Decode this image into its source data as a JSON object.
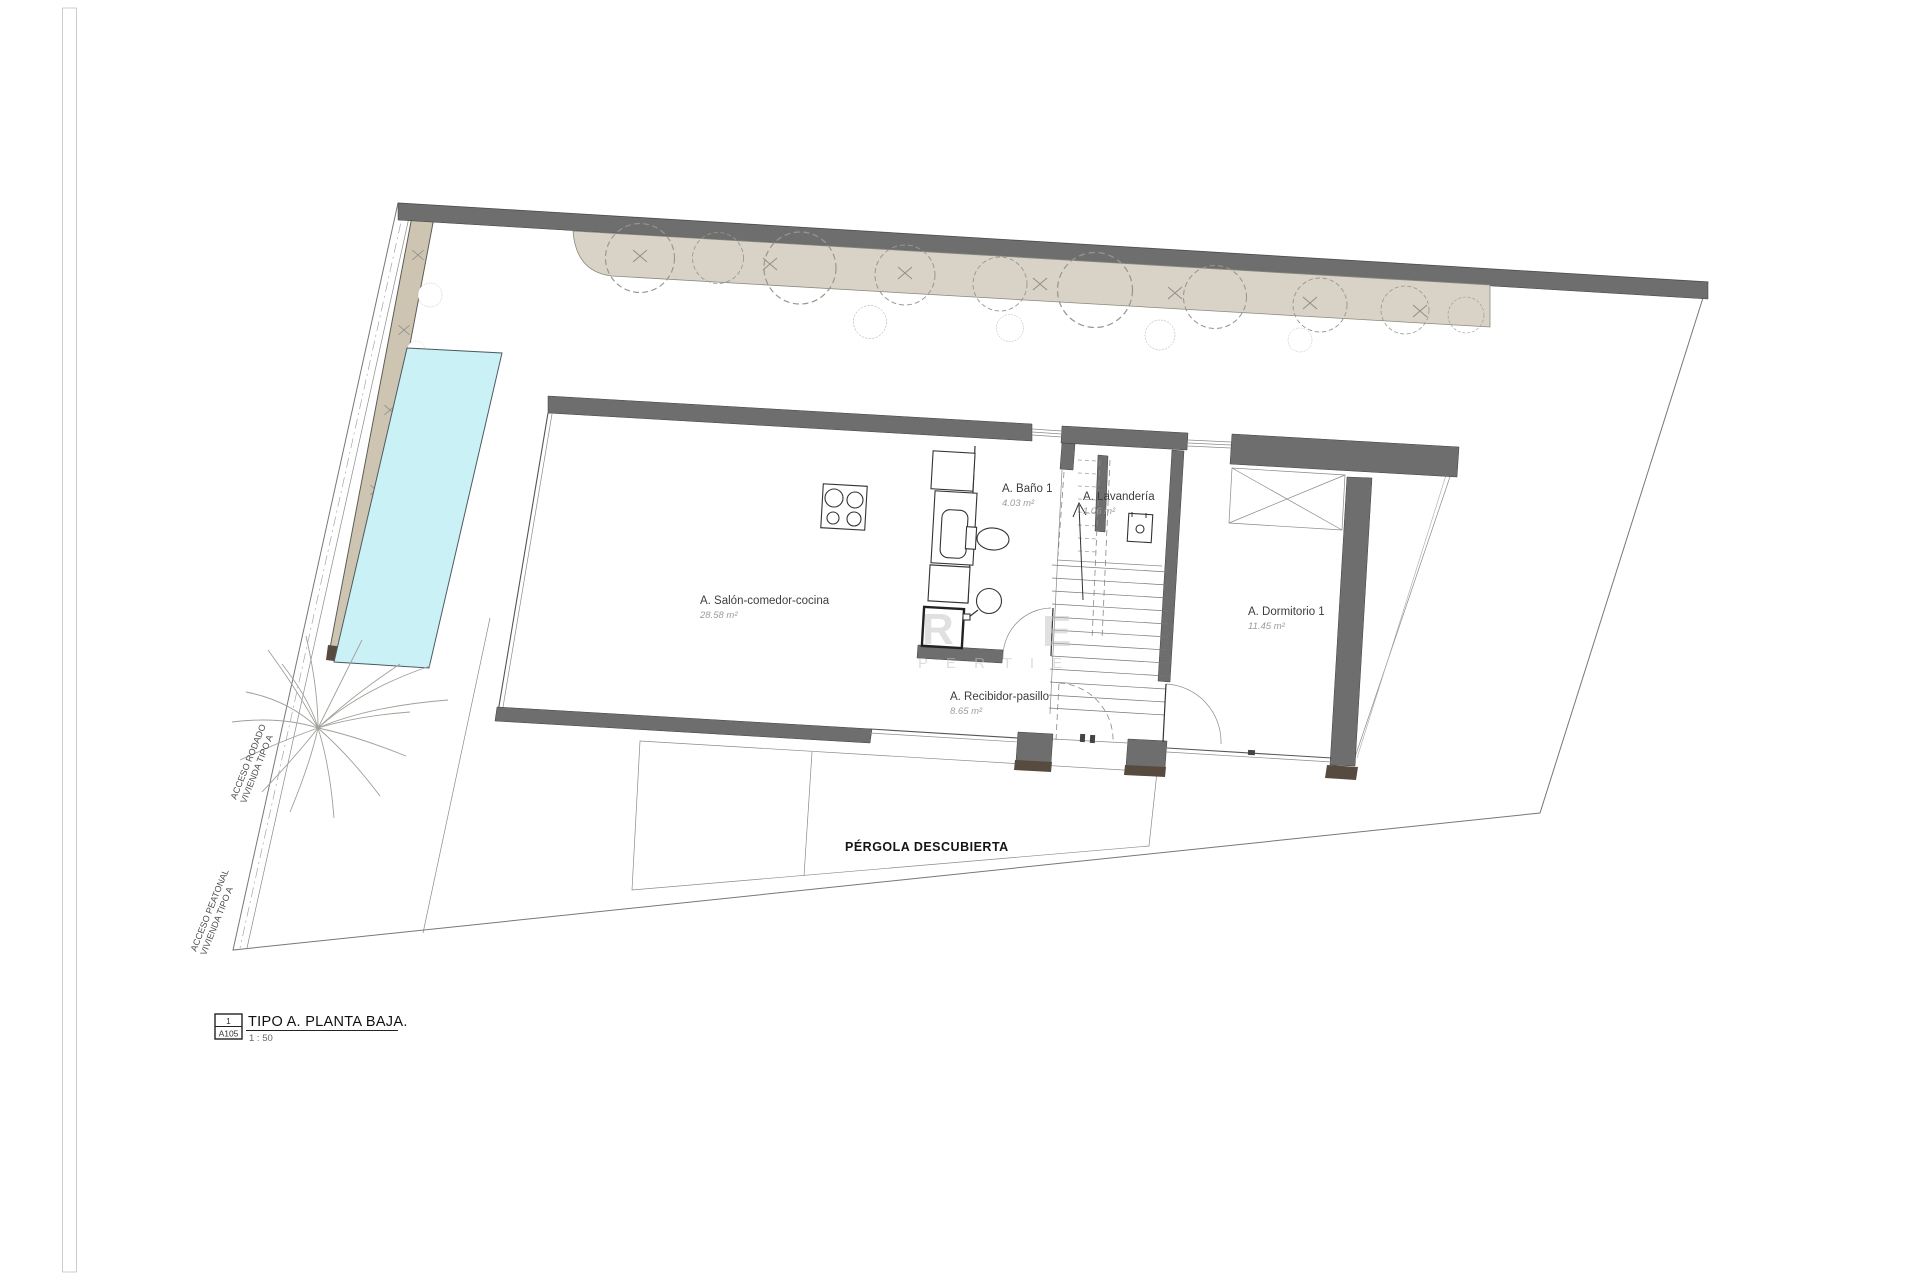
{
  "title_block": {
    "detail_number": "1",
    "sheet_code": "A105",
    "title": "TIPO A. PLANTA BAJA.",
    "scale": "1 : 50"
  },
  "rooms": [
    {
      "label": "A. Salón-comedor-cocina",
      "area": "28.58 m²"
    },
    {
      "label": "A. Baño 1",
      "area": "4.03 m²"
    },
    {
      "label": "A. Lavandería",
      "area": "1.06 m²"
    },
    {
      "label": "A. Dormitorio 1",
      "area": "11.45 m²"
    },
    {
      "label": "A. Recibidor-pasillo",
      "area": "8.65 m²"
    }
  ],
  "outdoor": {
    "pergola": "PÉRGOLA DESCUBIERTA"
  },
  "access_labels": {
    "rodado_line1": "ACCESO RODADO",
    "rodado_line2": "VIVIENDA TIPO A",
    "peatonal_line1": "ACCESO PEATONAL",
    "peatonal_line2": "VIVIENDA TIPO A"
  },
  "watermark": {
    "letter_r": "R",
    "letter_e": "E",
    "word": "P E R T I E"
  },
  "colors": {
    "wall": "#6e6e6e",
    "wall_base": "#574a3e",
    "pool": "#c9f1f6",
    "planting": "#d8d3c6",
    "path_band": "#cdc5b2",
    "paper": "#ffffff",
    "line": "#555555"
  }
}
